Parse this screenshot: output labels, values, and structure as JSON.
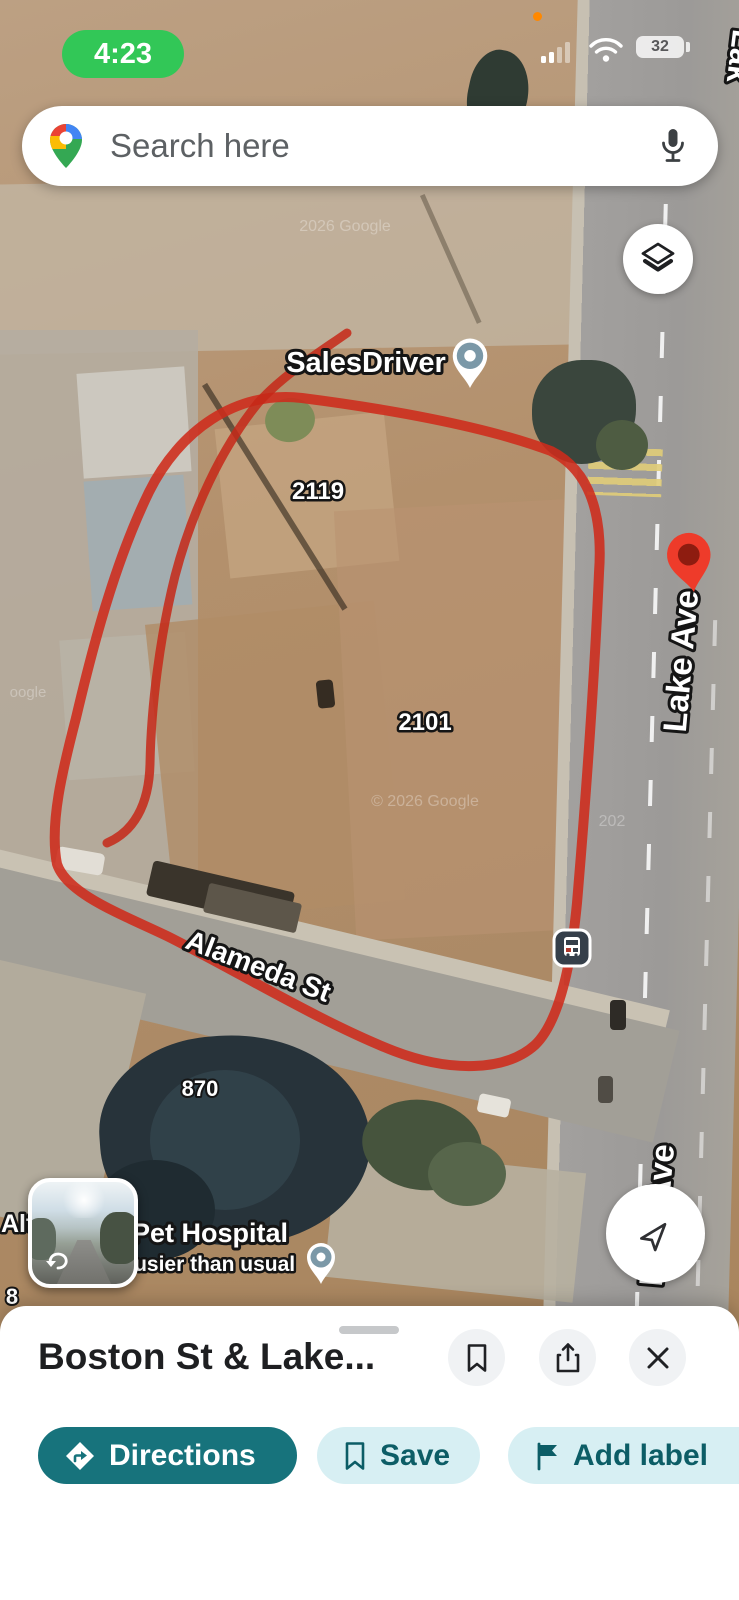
{
  "status_bar": {
    "time": "4:23",
    "battery_percent": "32"
  },
  "search": {
    "placeholder": "Search here"
  },
  "map": {
    "labels": {
      "business": "SalesDriver",
      "parcel_2119": "2119",
      "parcel_2101": "2101",
      "parcel_870": "870",
      "street_alameda": "Alameda St",
      "street_lake_top": "Lak",
      "street_lake_mid": "Lake Ave",
      "street_lake_bottom": "Lake Ave",
      "poi_partial": "Alt",
      "poi_pet_hospital": "Pet Hospital",
      "busyness": "Busier than usual",
      "partial_number": "8",
      "watermark_top": "2026 Google",
      "watermark_center": "© 2026 Google",
      "watermark_right": "202",
      "watermark_left": "oogle"
    },
    "colors": {
      "annotation_red": "#ce2b1b",
      "destination_pin_red": "#ee3b2a",
      "poi_marker_blue_gray": "#7b98a7",
      "time_pill_green": "#32c757",
      "accent_teal": "#17737c",
      "accent_teal_light": "#d7eff3",
      "accent_teal_text": "#0c5d66"
    }
  },
  "bottom_sheet": {
    "title": "Boston St & Lake...",
    "directions_label": "Directions",
    "save_label": "Save",
    "add_label_label": "Add label"
  }
}
